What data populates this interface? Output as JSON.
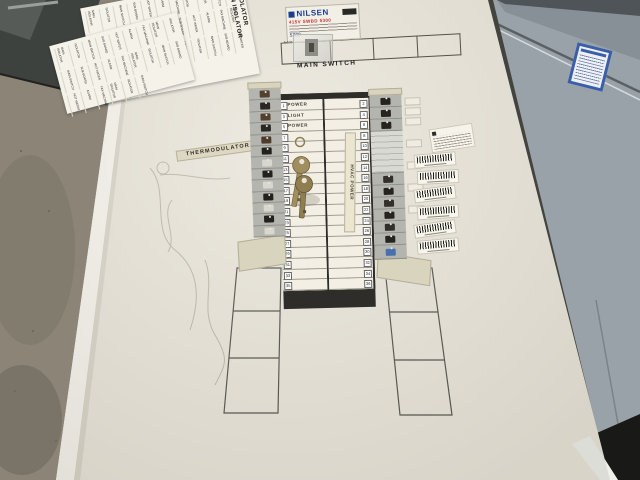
{
  "scene": {
    "subject": "electrical switchboard panel photo"
  },
  "board": {
    "rating_label": {
      "brand": "NILSEN",
      "line_red": "415V SWBD 5300",
      "handwritten": "5300"
    },
    "main_switch": {
      "label": "MAIN SWITCH",
      "cell_tag": "F-8-W",
      "empty_cells": 3
    },
    "thermodulator_label": "THERMODULATOR",
    "schedule": {
      "hvac_sticker": "HVAC POWER",
      "left_rows": [
        {
          "n": "1",
          "label": "POWER"
        },
        {
          "n": "3",
          "label": "LIGHT"
        },
        {
          "n": "5",
          "label": "POWER"
        },
        {
          "n": "7",
          "label": ""
        },
        {
          "n": "9",
          "label": ""
        },
        {
          "n": "11",
          "label": ""
        },
        {
          "n": "13",
          "label": ""
        },
        {
          "n": "15",
          "label": ""
        },
        {
          "n": "17",
          "label": ""
        },
        {
          "n": "19",
          "label": ""
        },
        {
          "n": "21",
          "label": ""
        },
        {
          "n": "23",
          "label": ""
        },
        {
          "n": "25",
          "label": ""
        },
        {
          "n": "27",
          "label": ""
        },
        {
          "n": "29",
          "label": ""
        },
        {
          "n": "31",
          "label": ""
        },
        {
          "n": "33",
          "label": ""
        },
        {
          "n": "35",
          "label": ""
        }
      ],
      "right_rows": [
        {
          "n": "2",
          "label": ""
        },
        {
          "n": "4",
          "label": ""
        },
        {
          "n": "6",
          "label": ""
        },
        {
          "n": "8",
          "label": ""
        },
        {
          "n": "10",
          "label": ""
        },
        {
          "n": "12",
          "label": ""
        },
        {
          "n": "14",
          "label": ""
        },
        {
          "n": "16",
          "label": ""
        },
        {
          "n": "18",
          "label": ""
        },
        {
          "n": "20",
          "label": ""
        },
        {
          "n": "22",
          "label": ""
        },
        {
          "n": "24",
          "label": ""
        },
        {
          "n": "26",
          "label": ""
        },
        {
          "n": "28",
          "label": ""
        },
        {
          "n": "30",
          "label": ""
        },
        {
          "n": "32",
          "label": ""
        },
        {
          "n": "34",
          "label": ""
        },
        {
          "n": "36",
          "label": ""
        }
      ]
    },
    "sticker_sheets": {
      "labels": [
        "MAIN ISOLATOR",
        "ISOLATOR",
        "MAIN SWITCH",
        "SUB BOARD",
        "HOT WATER",
        "ALARM",
        "FAX MACHINE"
      ],
      "big_words": [
        "MAIN ISOLATOR",
        "ISOLATOR"
      ]
    },
    "left_bank": {
      "toggle_colors": [
        "#53402f",
        "#2a2824",
        "#53402f",
        "#2a2824",
        "#4e3b2c",
        "#23211d",
        "#d7d6cf",
        "#23211d",
        "#d7d6cf",
        "#23211d",
        "#d7d6cf",
        "#23211d",
        "#d7d6cf"
      ]
    },
    "right_bank": {
      "modules": [
        {
          "type": "breaker",
          "color": "#26241f"
        },
        {
          "type": "breaker",
          "color": "#26241f"
        },
        {
          "type": "breaker",
          "color": "#26241f"
        },
        {
          "type": "blank"
        },
        {
          "type": "breaker",
          "color": "#33302a"
        },
        {
          "type": "breaker",
          "color": "#26241f"
        },
        {
          "type": "breaker",
          "color": "#33302a"
        },
        {
          "type": "breaker",
          "color": "#26241f"
        },
        {
          "type": "breaker",
          "color": "#33302a"
        },
        {
          "type": "breaker",
          "color": "#26241f"
        },
        {
          "type": "breaker",
          "color": "#4a6fae"
        }
      ],
      "label_tabs": 7
    },
    "barcode_stickers": {
      "count": 6
    },
    "keys": {
      "count": 2
    }
  },
  "colors": {
    "floor": "#8b8477",
    "board_white": "#e9e5da",
    "card_header": "#2e2d29",
    "cabinet_grey": "#99a2a8",
    "brand_blue": "#1c3d8e",
    "label_blue_border": "#3a5fa8",
    "brass": "#a08e5e"
  }
}
